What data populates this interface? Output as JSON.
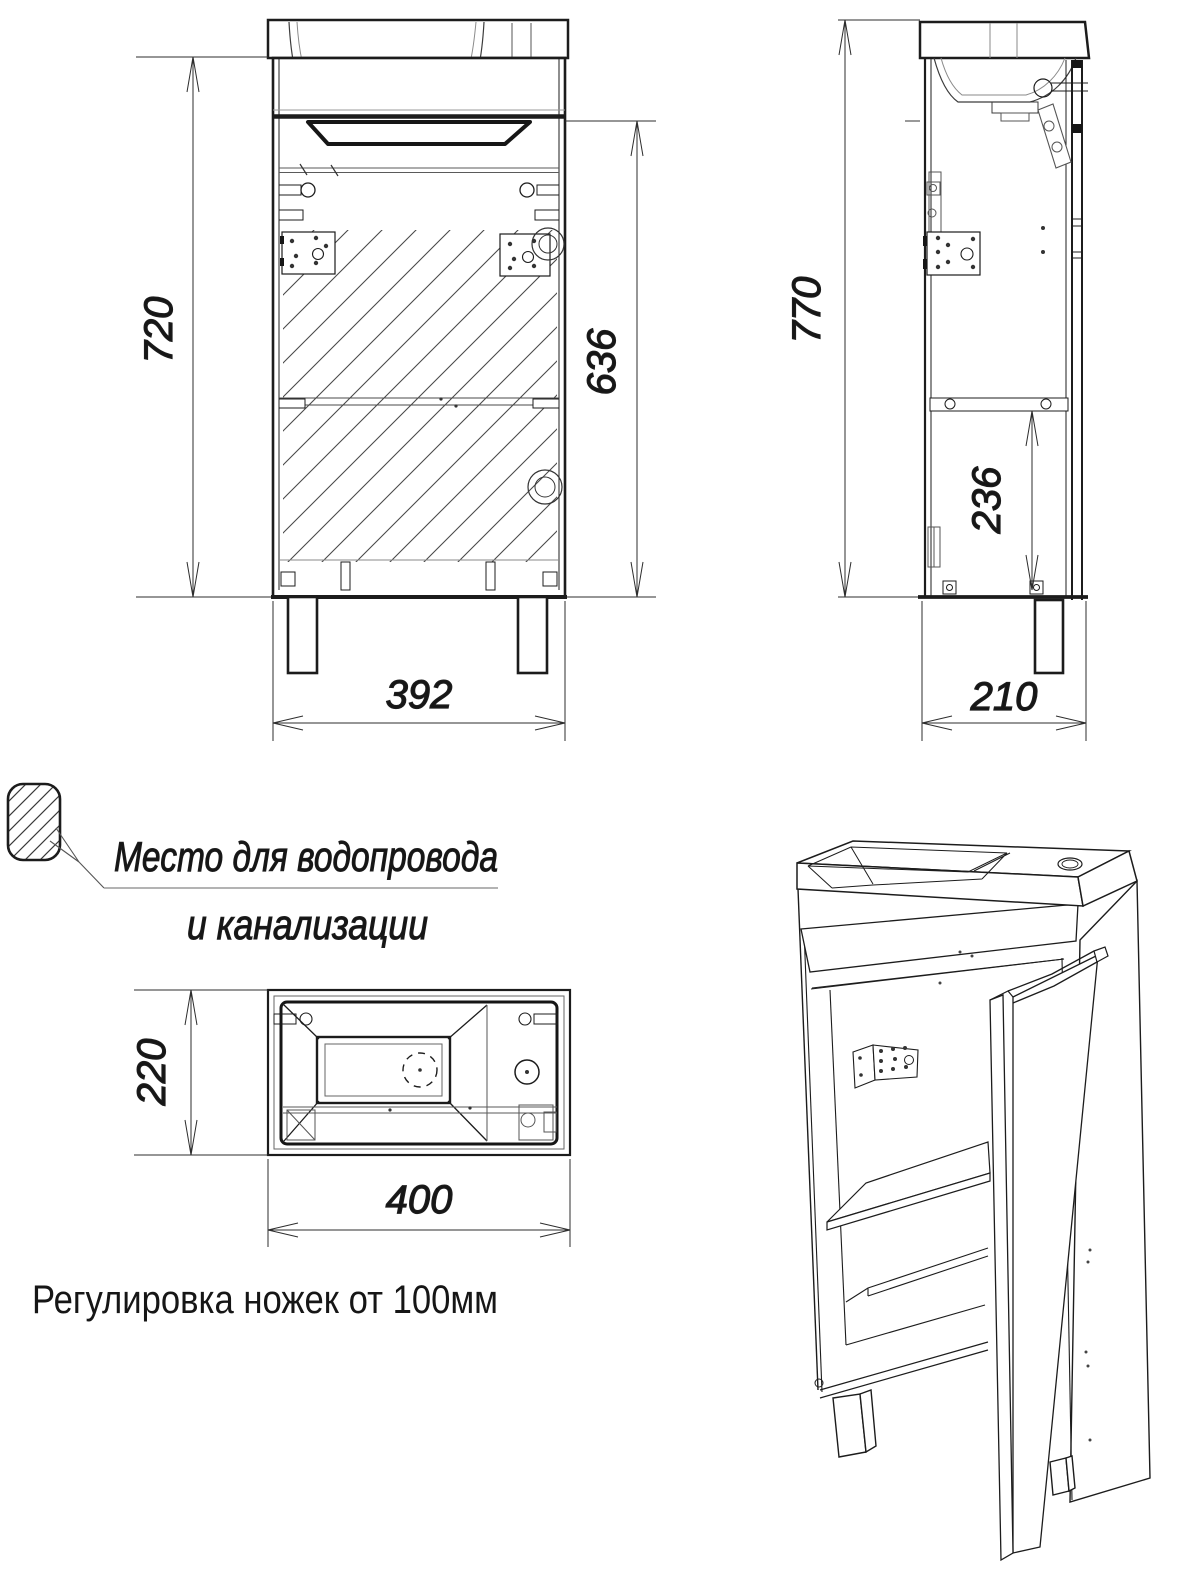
{
  "drawing": {
    "front_view": {
      "height_label": "720",
      "inner_height_label": "636",
      "width_label": "392"
    },
    "side_view": {
      "height_label": "770",
      "inner_height_label": "236",
      "depth_label": "210"
    },
    "top_view": {
      "depth_label": "220",
      "width_label": "400"
    },
    "legend": {
      "line1": "Место для водопровода",
      "line2": "и канализации",
      "swatch": "hatched-area"
    },
    "note": "Регулировка ножек от 100мм",
    "colors": {
      "line": "#1c1c1c",
      "thin_line": "#444444",
      "light_line": "#8a8a8a",
      "background": "#ffffff"
    }
  }
}
